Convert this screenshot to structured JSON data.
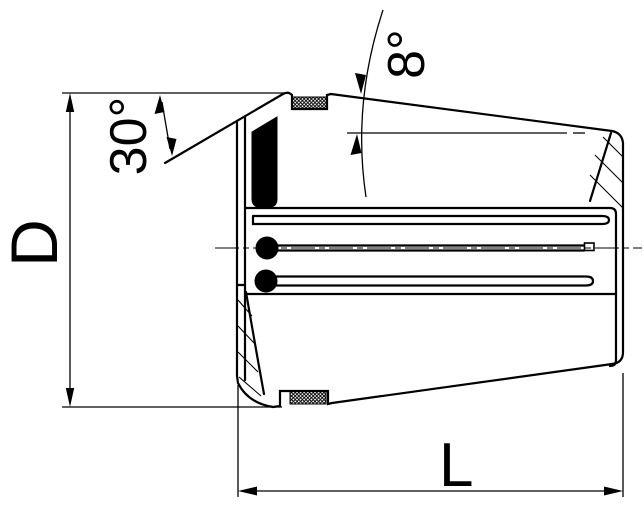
{
  "page": {
    "background": "#ffffff"
  },
  "drawing": {
    "title": "Sealed collet cross-section",
    "type": "technical-drawing",
    "labels": {
      "diameter": "D",
      "length": "L",
      "front_chamfer_angle": "30°",
      "taper_angle": "8°"
    },
    "colors": {
      "line": "#000000",
      "background": "#ffffff",
      "seal_fill": "#000000"
    }
  }
}
